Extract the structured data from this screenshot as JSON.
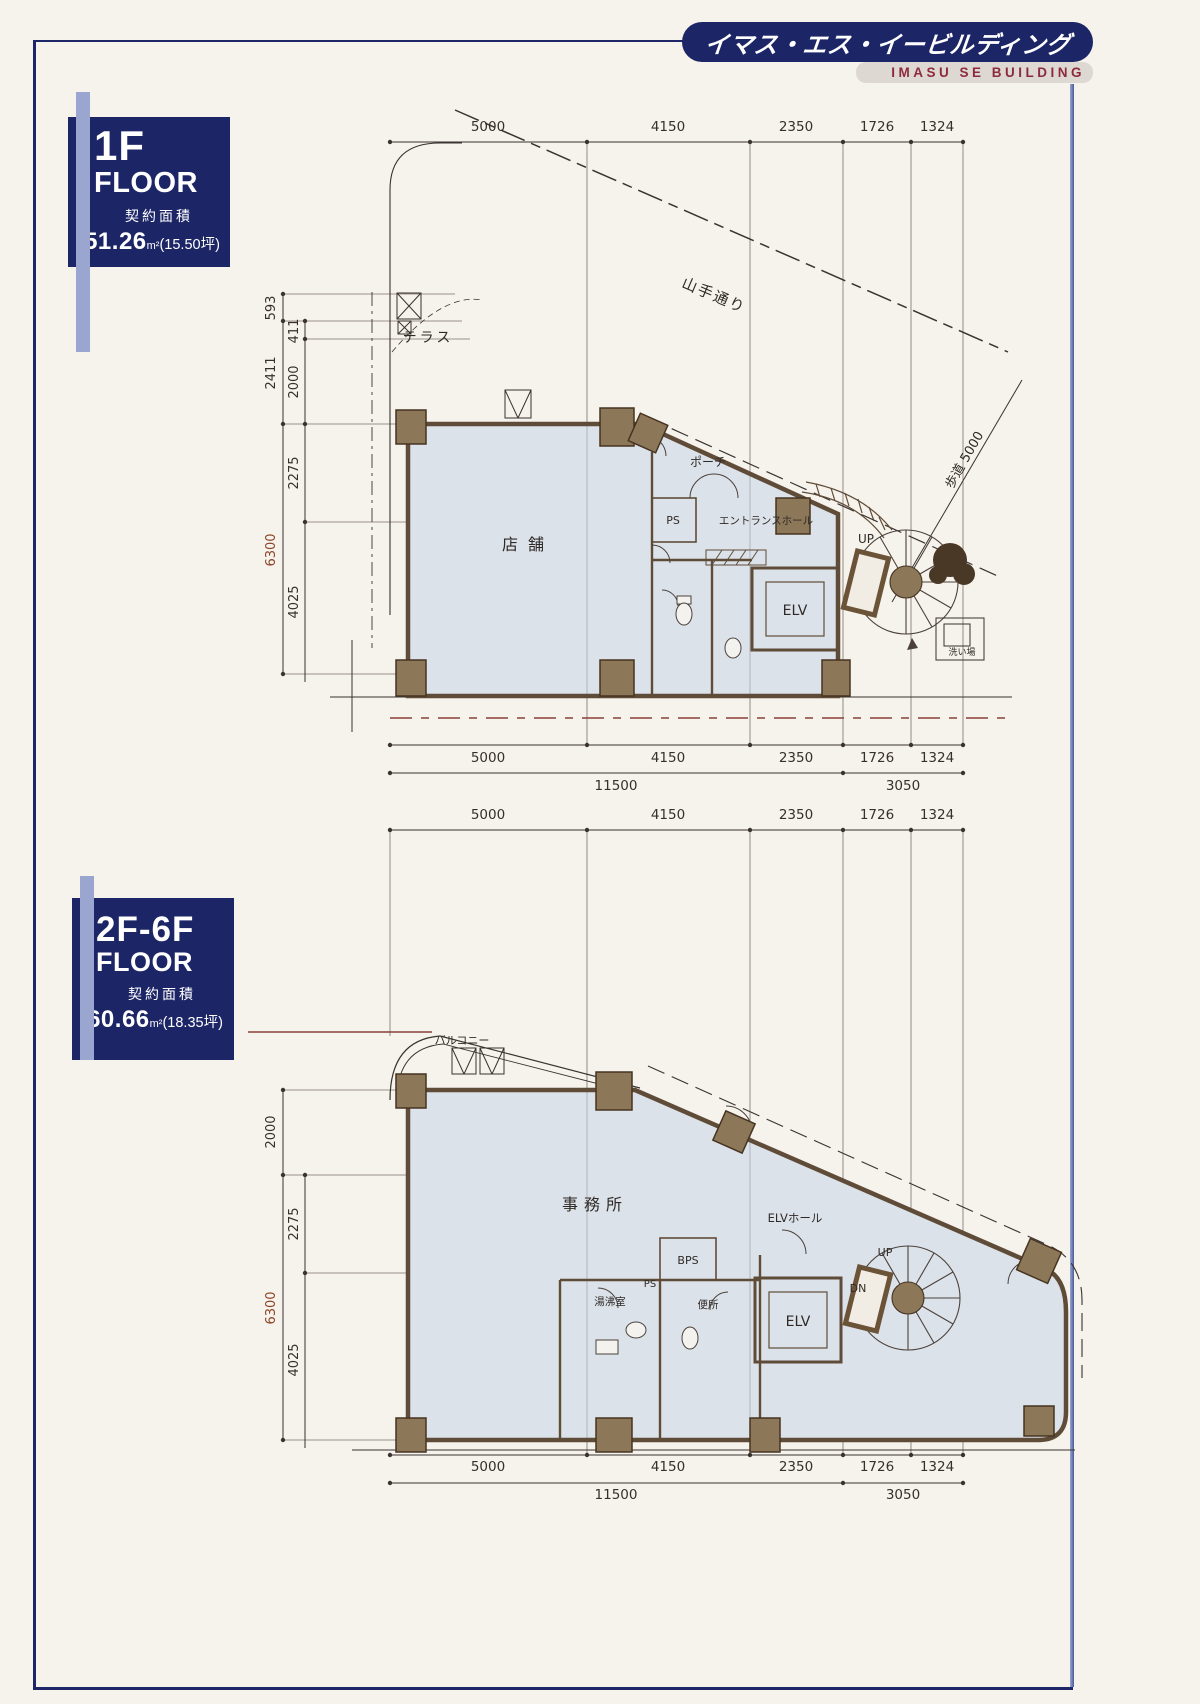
{
  "colors": {
    "navy": "#1c2566",
    "lavender": "#9aa6d0",
    "crimson": "#8e2a3e",
    "wall": "#5f4c38",
    "column": "#8d7759",
    "room_fill": "#dce2ea",
    "dim_brown": "#8a4426",
    "bg": "#f6f2ec"
  },
  "header": {
    "title_jp": "イマス・エス・イービルディング",
    "title_en": "IMASU SE BUILDING"
  },
  "floor1": {
    "floor": "1F",
    "word": "FLOOR",
    "caption": "契約面積",
    "value": "51.26",
    "unit": "m²",
    "tsubo": "(15.50坪)"
  },
  "floor2": {
    "floor": "2F-6F",
    "word": "FLOOR",
    "caption": "契約面積",
    "value": "60.66",
    "unit": "m²",
    "tsubo": "(18.35坪)"
  },
  "plan1": {
    "top_dims": [
      "5000",
      "4150",
      "2350",
      "1726",
      "1324"
    ],
    "bottom_dims": [
      "5000",
      "4150",
      "2350",
      "1726",
      "1324"
    ],
    "totals": [
      "11500",
      "3050"
    ],
    "left_outer": [
      "593",
      "2411",
      "6300"
    ],
    "left_inner": [
      "411",
      "2000",
      "2275",
      "4025"
    ],
    "street": "山手通り",
    "sidewalk": "歩道 5000",
    "terrace": "テラス",
    "store": "店舗",
    "porch": "ポーチ",
    "ps": "PS",
    "entrance_hall": "エントランスホール",
    "elv": "ELV",
    "up": "UP",
    "wash": "洗い場"
  },
  "plan2": {
    "top_dims": [
      "5000",
      "4150",
      "2350",
      "1726",
      "1324"
    ],
    "bottom_dims": [
      "5000",
      "4150",
      "2350",
      "1726",
      "1324"
    ],
    "totals": [
      "11500",
      "3050"
    ],
    "left_outer": [
      "2000",
      "6300"
    ],
    "left_inner": [
      "2275",
      "4025"
    ],
    "balcony": "バルコニー",
    "office": "事務所",
    "elv_hall": "ELVホール",
    "elv": "ELV",
    "up": "UP",
    "dn": "DN",
    "bps": "BPS",
    "ps": "PS",
    "kitchenette": "湯沸室",
    "toilet": "便所"
  }
}
